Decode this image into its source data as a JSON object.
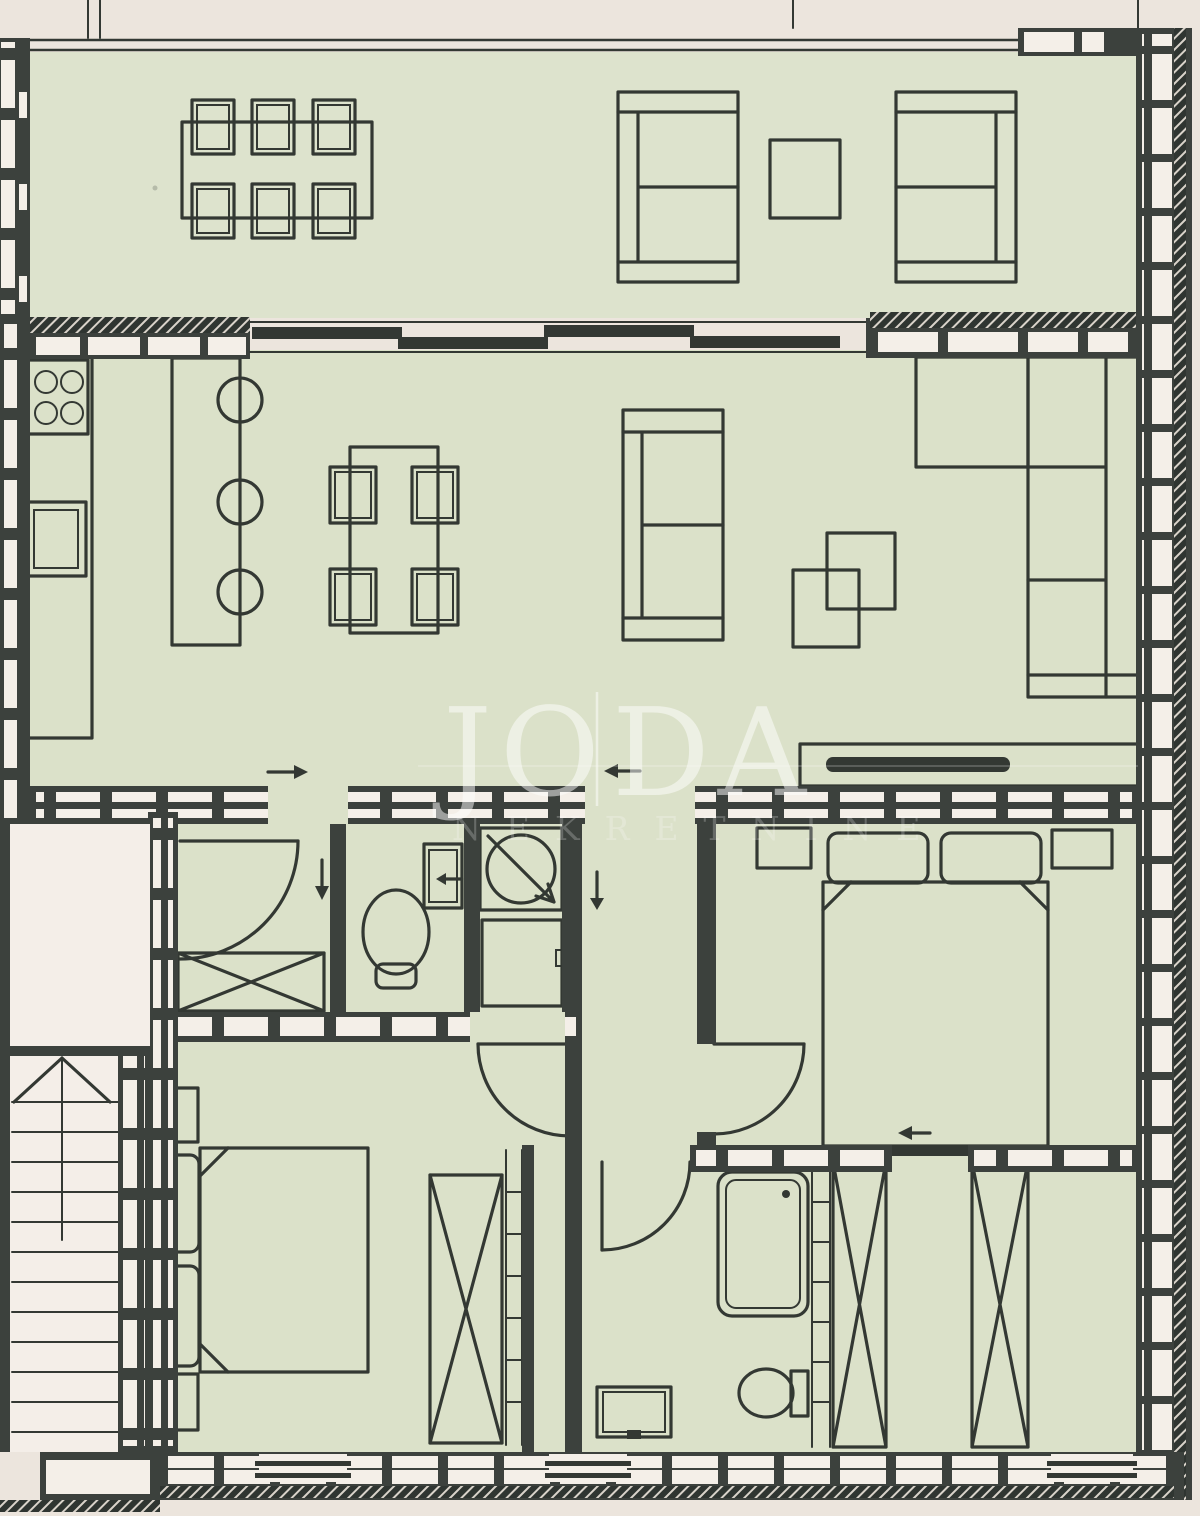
{
  "image": {
    "kind": "scanned apartment floor plan",
    "orientation": "portrait"
  },
  "watermark": {
    "brand_left": "JO",
    "brand_right": "DA",
    "subtitle": "NEKRETNINE"
  },
  "palette": {
    "paper": "#ece5dd",
    "floor": "#dbe1c9",
    "terrace_floor": "#dde3cd",
    "wall": "#3c413d",
    "furniture_line": "#333833",
    "masonry_block": "#f4efe8",
    "hatch_bg": "#2f3531",
    "watermark_text": "#ffffff"
  },
  "icons": [
    "outdoor-dining-table-six-chairs-icon",
    "patio-sofa-pair-icon",
    "patio-side-table-icon",
    "stove-four-burners-icon",
    "kitchen-sink-icon",
    "kitchen-island-three-stools-icon",
    "dining-table-four-chairs-icon",
    "two-seat-sofa-icon",
    "nesting-coffee-tables-icon",
    "corner-sofa-icon",
    "tv-sideboard-icon",
    "door-swing-arc-icon",
    "wardrobe-cross-icon",
    "toilet-icon",
    "wall-basin-icon",
    "washing-machine-icon",
    "appliance-box-icon",
    "double-bed-icon",
    "pillow-icon",
    "nightstand-icon",
    "shower-cabin-icon",
    "staircase-icon",
    "direction-arrow-icon",
    "sliding-glass-door-icon",
    "masonry-wall-icon"
  ]
}
